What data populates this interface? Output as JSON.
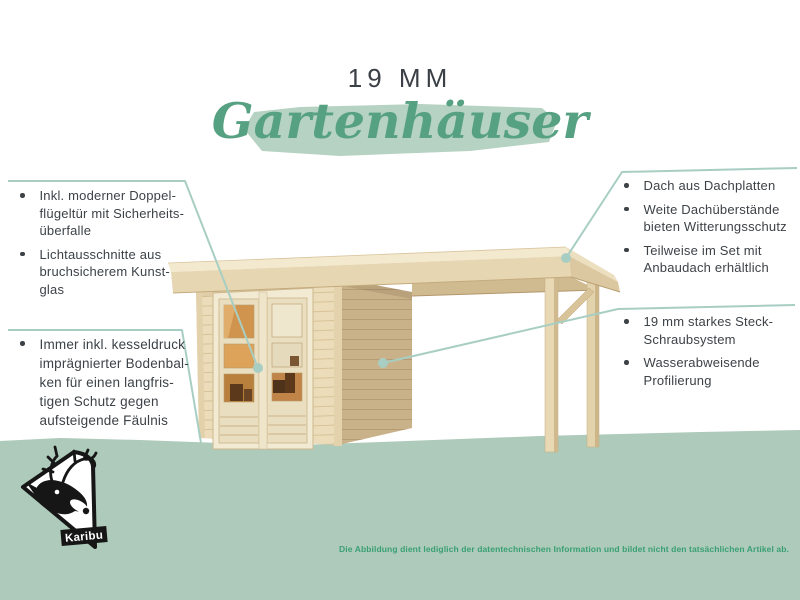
{
  "header": {
    "thickness_label": "19 MM",
    "title": "Gartenhäuser"
  },
  "callouts": {
    "left_top": {
      "items": [
        {
          "lines": [
            "Inkl. moderner Doppel-",
            "flügeltür mit Sicherheits-",
            "überfalle"
          ]
        },
        {
          "lines": [
            "Lichtausschnitte aus",
            "bruchsicherem Kunst-",
            "glas"
          ]
        }
      ]
    },
    "left_bottom": {
      "items": [
        {
          "lines": [
            "Immer inkl. kesseldruck",
            "imprägnierter Bodenbal-",
            "ken für einen langfris-",
            "tigen Schutz gegen",
            "aufsteigende Fäulnis"
          ]
        }
      ]
    },
    "right_top": {
      "items": [
        {
          "lines": [
            "Dach aus Dachplatten"
          ]
        },
        {
          "lines": [
            "Weite Dachüberstände",
            "bieten Witterungsschutz"
          ]
        },
        {
          "lines": [
            "Teilweise im Set mit",
            "Anbaudach erhältlich"
          ]
        }
      ]
    },
    "right_bottom": {
      "items": [
        {
          "lines": [
            "19 mm starkes Steck-",
            "Schraubsystem"
          ]
        },
        {
          "lines": [
            "Wasserabweisende",
            "Profilierung"
          ]
        }
      ]
    }
  },
  "logo": {
    "brand": "Karibu",
    "icon": "deer-in-pennant-icon"
  },
  "footer": {
    "disclaimer": "Die Abbildung dient lediglich der datentechnischen Information und bildet nicht den tatsächlichen Artikel ab."
  },
  "colors": {
    "background": "#ffffff",
    "text_dark": "#3d4247",
    "script_green": "#57a183",
    "brush_green": "#b6d2c2",
    "band_green": "#adcaba",
    "connector_teal": "#a8cec4",
    "disclaimer_green": "#3a9f74",
    "wood_light": "#ecdcb9",
    "wood_dark": "#c9b28a"
  }
}
